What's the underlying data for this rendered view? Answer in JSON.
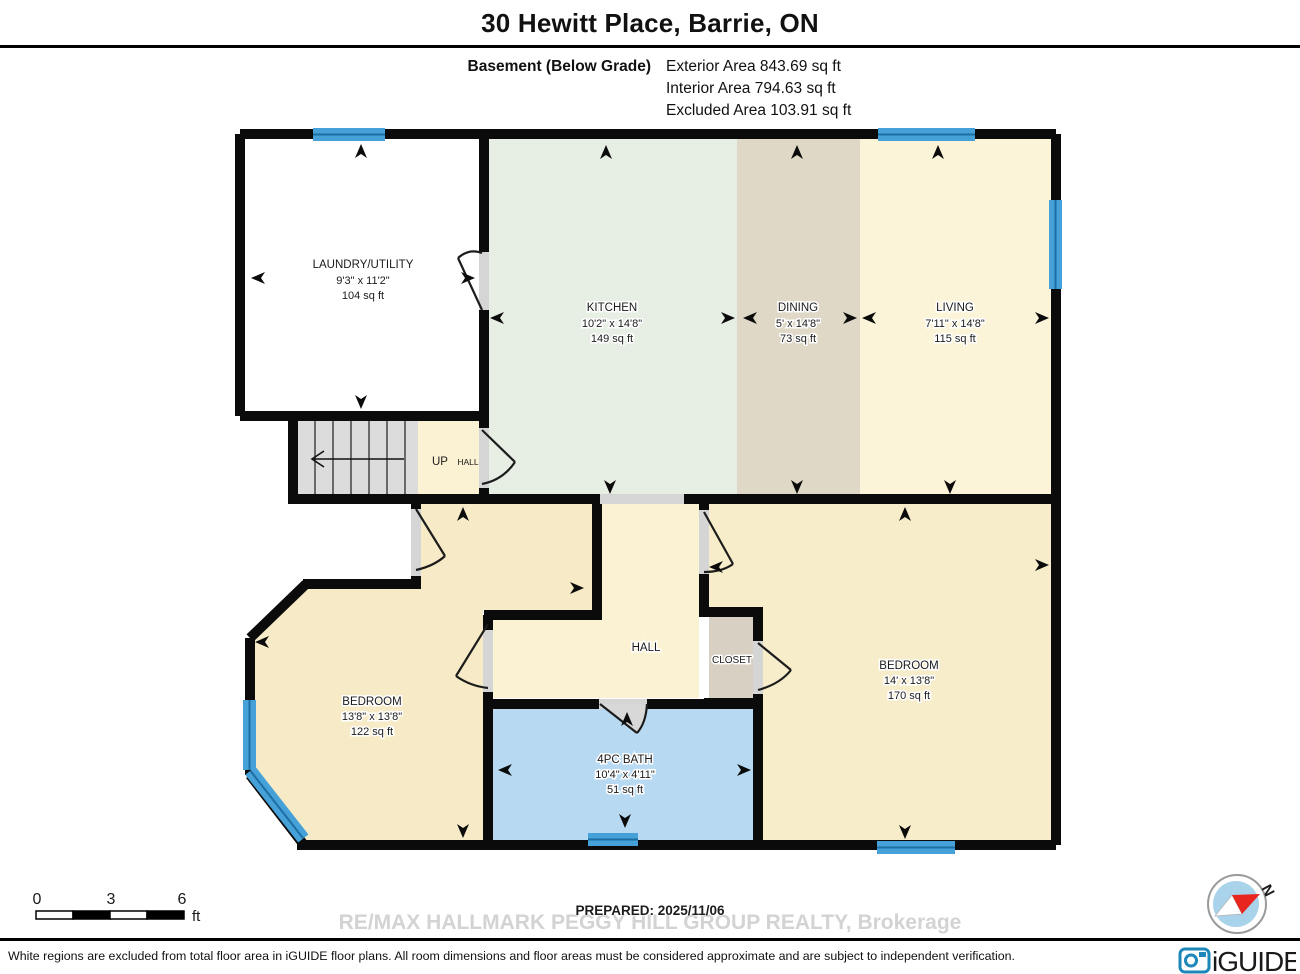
{
  "header": {
    "title": "30 Hewitt Place, Barrie, ON",
    "floor": "Basement (Below Grade)",
    "area_lines": [
      "Exterior Area 843.69 sq ft",
      "Interior Area 794.63 sq ft",
      "Excluded Area 103.91 sq ft"
    ]
  },
  "rooms": {
    "laundry": {
      "name": "LAUNDRY/UTILITY",
      "dims": "9'3\" x 11'2\"",
      "area": "104 sq ft"
    },
    "kitchen": {
      "name": "KITCHEN",
      "dims": "10'2\" x 14'8\"",
      "area": "149 sq ft"
    },
    "dining": {
      "name": "DINING",
      "dims": "5' x 14'8\"",
      "area": "73 sq ft"
    },
    "living": {
      "name": "LIVING",
      "dims": "7'11\" x 14'8\"",
      "area": "115 sq ft"
    },
    "bedroom_left": {
      "name": "BEDROOM",
      "dims": "13'8\" x 13'8\"",
      "area": "122 sq ft"
    },
    "bedroom_right": {
      "name": "BEDROOM",
      "dims": "14' x 13'8\"",
      "area": "170 sq ft"
    },
    "bath": {
      "name": "4PC BATH",
      "dims": "10'4\" x 4'11\"",
      "area": "51 sq ft"
    },
    "hall": {
      "name": "HALL"
    },
    "closet": {
      "name": "CLOSET"
    },
    "stairs_up": {
      "name": "UP"
    },
    "stairs_hall": {
      "name": "HALL"
    }
  },
  "scale_bar": {
    "ticks": [
      "0",
      "3",
      "6"
    ],
    "unit": "ft"
  },
  "footer": {
    "prepared": "PREPARED: 2025/11/06",
    "watermark": "RE/MAX HALLMARK PEGGY HILL GROUP REALTY, Brokerage",
    "disclaimer": "White regions are excluded from total floor area in iGUIDE floor plans. All room dimensions and floor areas must be considered approximate and are subject to independent verification.",
    "brand": "iGUIDE",
    "north": "N"
  },
  "colors": {
    "wall": "#0b0b0b",
    "kitchen": "#e7efe4",
    "dining": "#dfd8c6",
    "living": "#fbf4d9",
    "bedroom": "#f7ebc7",
    "hall": "#fbf2d4",
    "bath": "#b7daf2",
    "closet": "#d8d0c3",
    "stairs": "#dcdcdc",
    "window": "#45a1d8",
    "brand_blue": "#1d87ba"
  }
}
